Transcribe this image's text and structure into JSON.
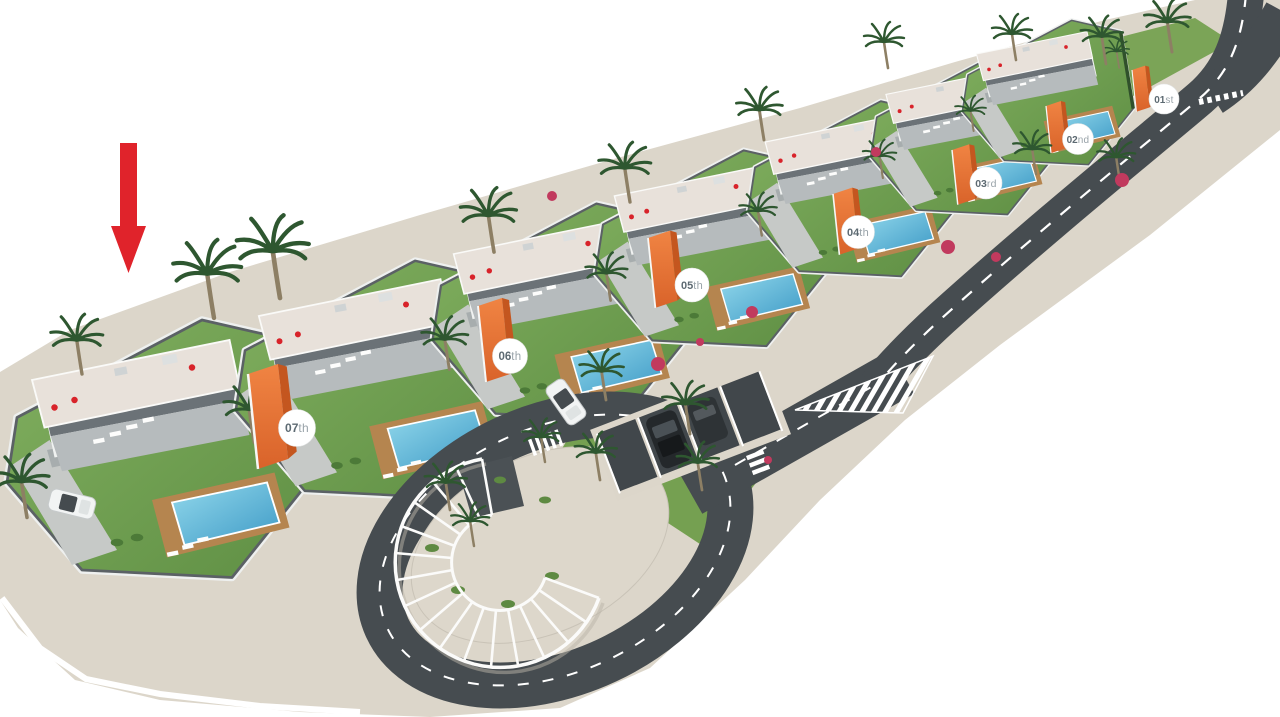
{
  "units": [
    {
      "label": "01st",
      "num": "01",
      "suffix": "st"
    },
    {
      "label": "02nd",
      "num": "02",
      "suffix": "nd"
    },
    {
      "label": "03rd",
      "num": "03",
      "suffix": "rd"
    },
    {
      "label": "04th",
      "num": "04",
      "suffix": "th"
    },
    {
      "label": "05th",
      "num": "05",
      "suffix": "th"
    },
    {
      "label": "06th",
      "num": "06",
      "suffix": "th"
    },
    {
      "label": "07th",
      "num": "07",
      "suffix": "th"
    }
  ],
  "colors": {
    "arrow_red": "#e0232b",
    "accent_orange": "#e46f33",
    "accent_orange_dark": "#c4561f",
    "pool_blue": "#55b4d9",
    "lawn_green": "#74a455",
    "palm_green": "#2e5730",
    "road_asphalt": "#464c50",
    "pavement_beige": "#dcd6ca",
    "roof_light": "#e8e1da",
    "deck_wood": "#b5854f",
    "wall_dark": "#5b6165",
    "structure_white": "#f0f2f1",
    "badge_bg": "#ffffff",
    "badge_number_text": "#5d6a72",
    "badge_suffix_text": "#99a3a9"
  }
}
